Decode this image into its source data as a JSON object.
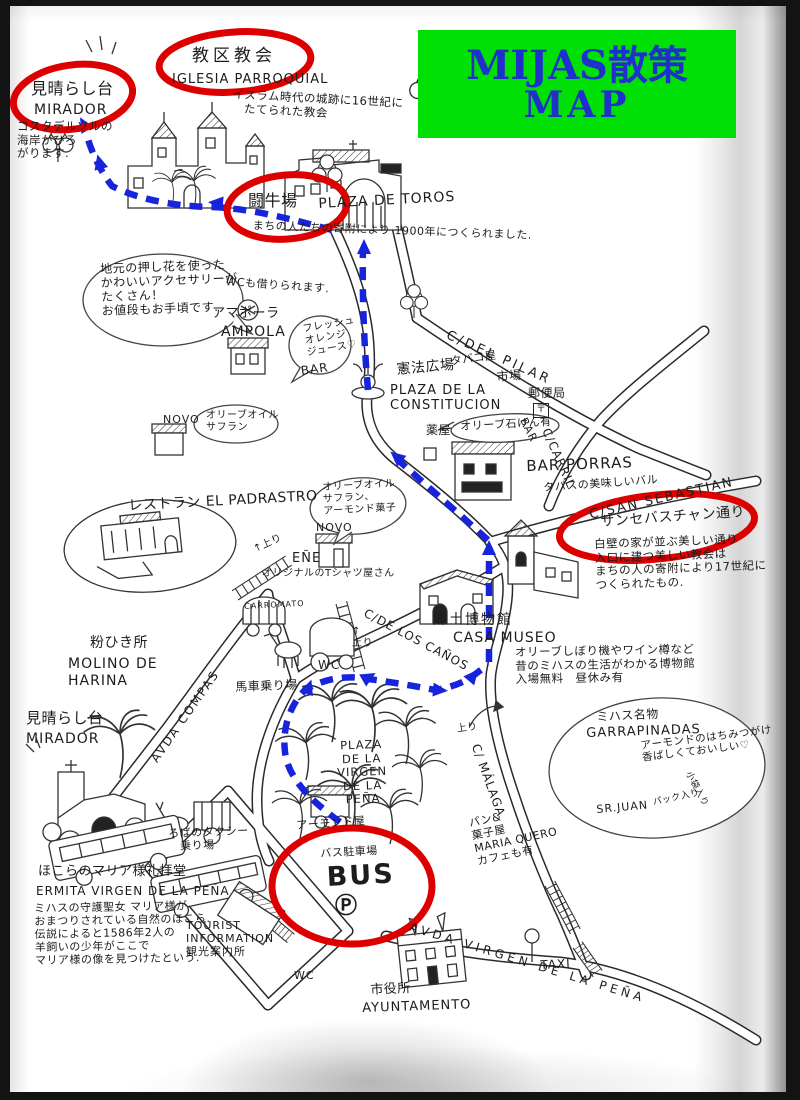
{
  "title": {
    "line1": "MIJAS散策",
    "line2": "MAP"
  },
  "colors": {
    "title_bg": "#00e005",
    "title_text": "#2030cc",
    "route_blue": "#1823dc",
    "circle_red": "#dd0000",
    "ink": "#1c1c1c"
  },
  "labels": {
    "iglesia_jp": "教区教会",
    "iglesia_es": "IGLESIA PARROQUIAL",
    "iglesia_note": "イスラム時代の城跡に16世紀に\n　たてられた教会",
    "mirador_top_jp": "見晴らし台",
    "mirador_top_es": "MIRADOR",
    "costa_note": "コスタデルソルの\n海岸がひろ\nがります.",
    "toros_jp": "闘牛場",
    "toros_es": "PLAZA DE TOROS",
    "toros_note": "まちの人たちの寄附により 1900年につくられました.",
    "oshibana_note": "地元の押し花を使った\nかわいいアクセサリーが\nたくさん！\nお値段もお手頃です.",
    "wc_rent_note": "WCも借りられます.",
    "ampola_jp": "アマポーラ",
    "ampola_es": "AMPOLA",
    "juice_note": "フレッシュ\nオレンジ\nジュース♡",
    "juice_bar": "BAR",
    "constitucion_jp": "憲法広場",
    "constitucion_es": "PLAZA DE LA\nCONSTITUCION",
    "del_pilar": "C/DEL PILAR",
    "tabaco": "タバコ屋",
    "ichiba": "市場",
    "yubinkyoku": "郵便局",
    "postal_mark": "〒",
    "bar_small": "BAR",
    "carril": "C/CARRIL",
    "kusuriya": "薬屋",
    "soap_note": "オリーブ石けん有",
    "novo1": "NOVO",
    "oil1_note": "オリーブオイル\nサフラン",
    "bar_porras": "BAR PORRAS",
    "porras_note": "タパスの美味しいバル",
    "san_sebastian": "C/SAN SEBASTIAN",
    "sanseba_jp": "サンセバスチャン通り",
    "sanseba_note": "白壁の家が並ぶ美しい通り\n入口に建つ美しい教会は\nまちの人の寄附により17世紀に\nつくられたもの.",
    "padrastro": "レストラン EL PADRASTRO",
    "ene_nobori": "↑上り",
    "ene": "EÑE",
    "ene_note": "オリジナルのTシャツ屋さん",
    "novo2": "NOVO",
    "oil2_note": "オリーブオイル\nサフラン、\nアーモンド菓子",
    "museo_jp": "郷土博物館",
    "museo_es": "CASA MUSEO",
    "museo_note": "オリーブしぼり機やワイン樽など\n昔のミハスの生活がわかる博物館\n入場無料　昼休み有",
    "los_canos": "C/DE LOS CAÑOS",
    "molino_jp": "粉ひき所",
    "molino_es": "MOLINO DE\n HARINA",
    "avda_compas": "AVDA COMPAS",
    "carromato": "CARROMATO",
    "basha": "馬車乗り場",
    "wc2": "WC",
    "nobori2": "↑\n上り",
    "mirador2_jp": "見晴らし台",
    "mirador2_es": "MIRADOR",
    "meibutsu": "ミハス名物",
    "garrapinadas": "GARRAPINADAS",
    "garra_note": "アーモンドのはちみつがけ\n香ばしくておいしい♡",
    "pack_note": "パック入り",
    "kobukuro_note": "小袋入り",
    "sr_juan": "SR.JUAN",
    "plaza_virgen": "PLAZA\nDE LA VIRGEN\nDE LA PEÑA",
    "almond_shop": "アーモンド屋",
    "roba_taxi": "ろばのタクシー\n　乗り場",
    "malaga": "C/ MÁLAGA",
    "nobori3": "上り",
    "pan_shop": "パン&\n菓子屋\nMARIA QUERO\nカフェも有",
    "bus_lot": "バス駐車場",
    "bus_big": "BUS",
    "bus_p": "Ⓟ",
    "tourist": "TOURIST\nINFORMATION\n観光案内所",
    "wc3": "WC",
    "shiyakusho_jp": "市役所",
    "ayuntamiento": "AYUNTAMENTO",
    "avda_virgen": "AVDA VIRGEN DE LA PEÑA",
    "taxi": "TAXI",
    "ermita_jp": "ほこらのマリア様礼拝堂",
    "ermita_es": "ERMITA VIRGEN DE LA PEÑA",
    "ermita_note": "ミハスの守護聖女 マリア様が\nおまつりされている自然のほこら.\n伝説によると1586年2人の\n羊飼いの少年がここで\nマリア様の像を見つけたという."
  }
}
